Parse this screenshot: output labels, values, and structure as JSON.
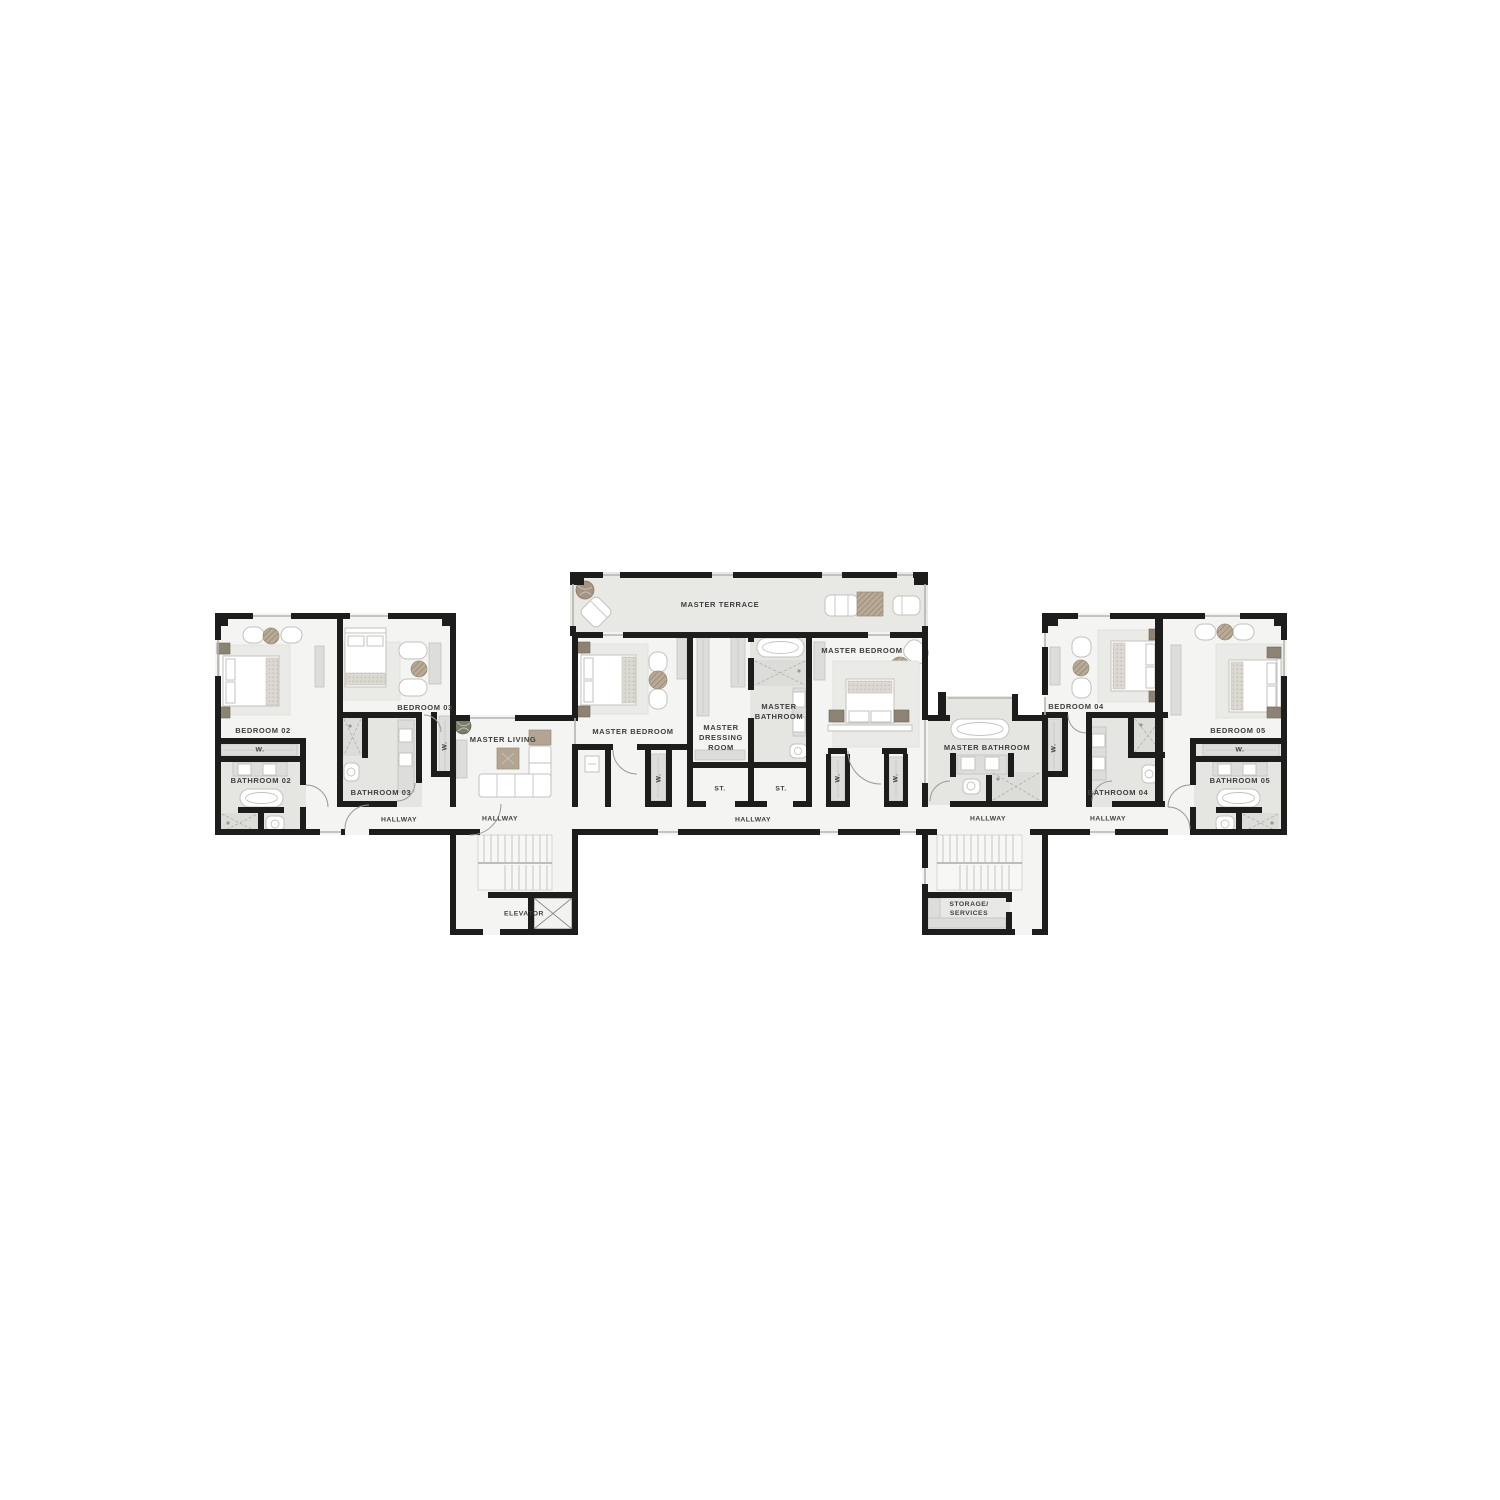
{
  "title": "Floor plan",
  "colors": {
    "wall": "#1d1d1b",
    "floor": "#f4f4f2",
    "terrace": "#e8e8e5",
    "bathFloor": "#e5e5e2",
    "showerFloor": "#dcdcd9",
    "wardrobe": "#dddddb",
    "furnEdge": "#c2c2be",
    "rug": "#eaeae7",
    "wood": "#b4a492",
    "nightstand": "#8c8375",
    "labelColor": "#3e3e3c",
    "bg": "#ffffff"
  },
  "labels": {
    "masterTerrace": "MASTER TERRACE",
    "bedroom02": "BEDROOM 02",
    "bathroom02": "BATHROOM 02",
    "bedroom03": "BEDROOM 03",
    "bathroom03": "BATHROOM 03",
    "bedroom04": "BEDROOM 04",
    "bathroom04": "BATHROOM 04",
    "bedroom05": "BEDROOM 05",
    "bathroom05": "BATHROOM 05",
    "masterBedroom": "MASTER BEDROOM",
    "masterDressingRoom": "MASTER\nDRESSING\nROOM",
    "masterBathroomStacked": "MASTER\nBATHROOM",
    "masterBathroom": "MASTER BATHROOM",
    "masterLiving": "MASTER LIVING",
    "hallway": "HALLWAY",
    "closetW": "W.",
    "closetSt": "ST.",
    "elevator": "ELEVATOR",
    "storageServices": "STORAGE/\nSERVICES"
  }
}
